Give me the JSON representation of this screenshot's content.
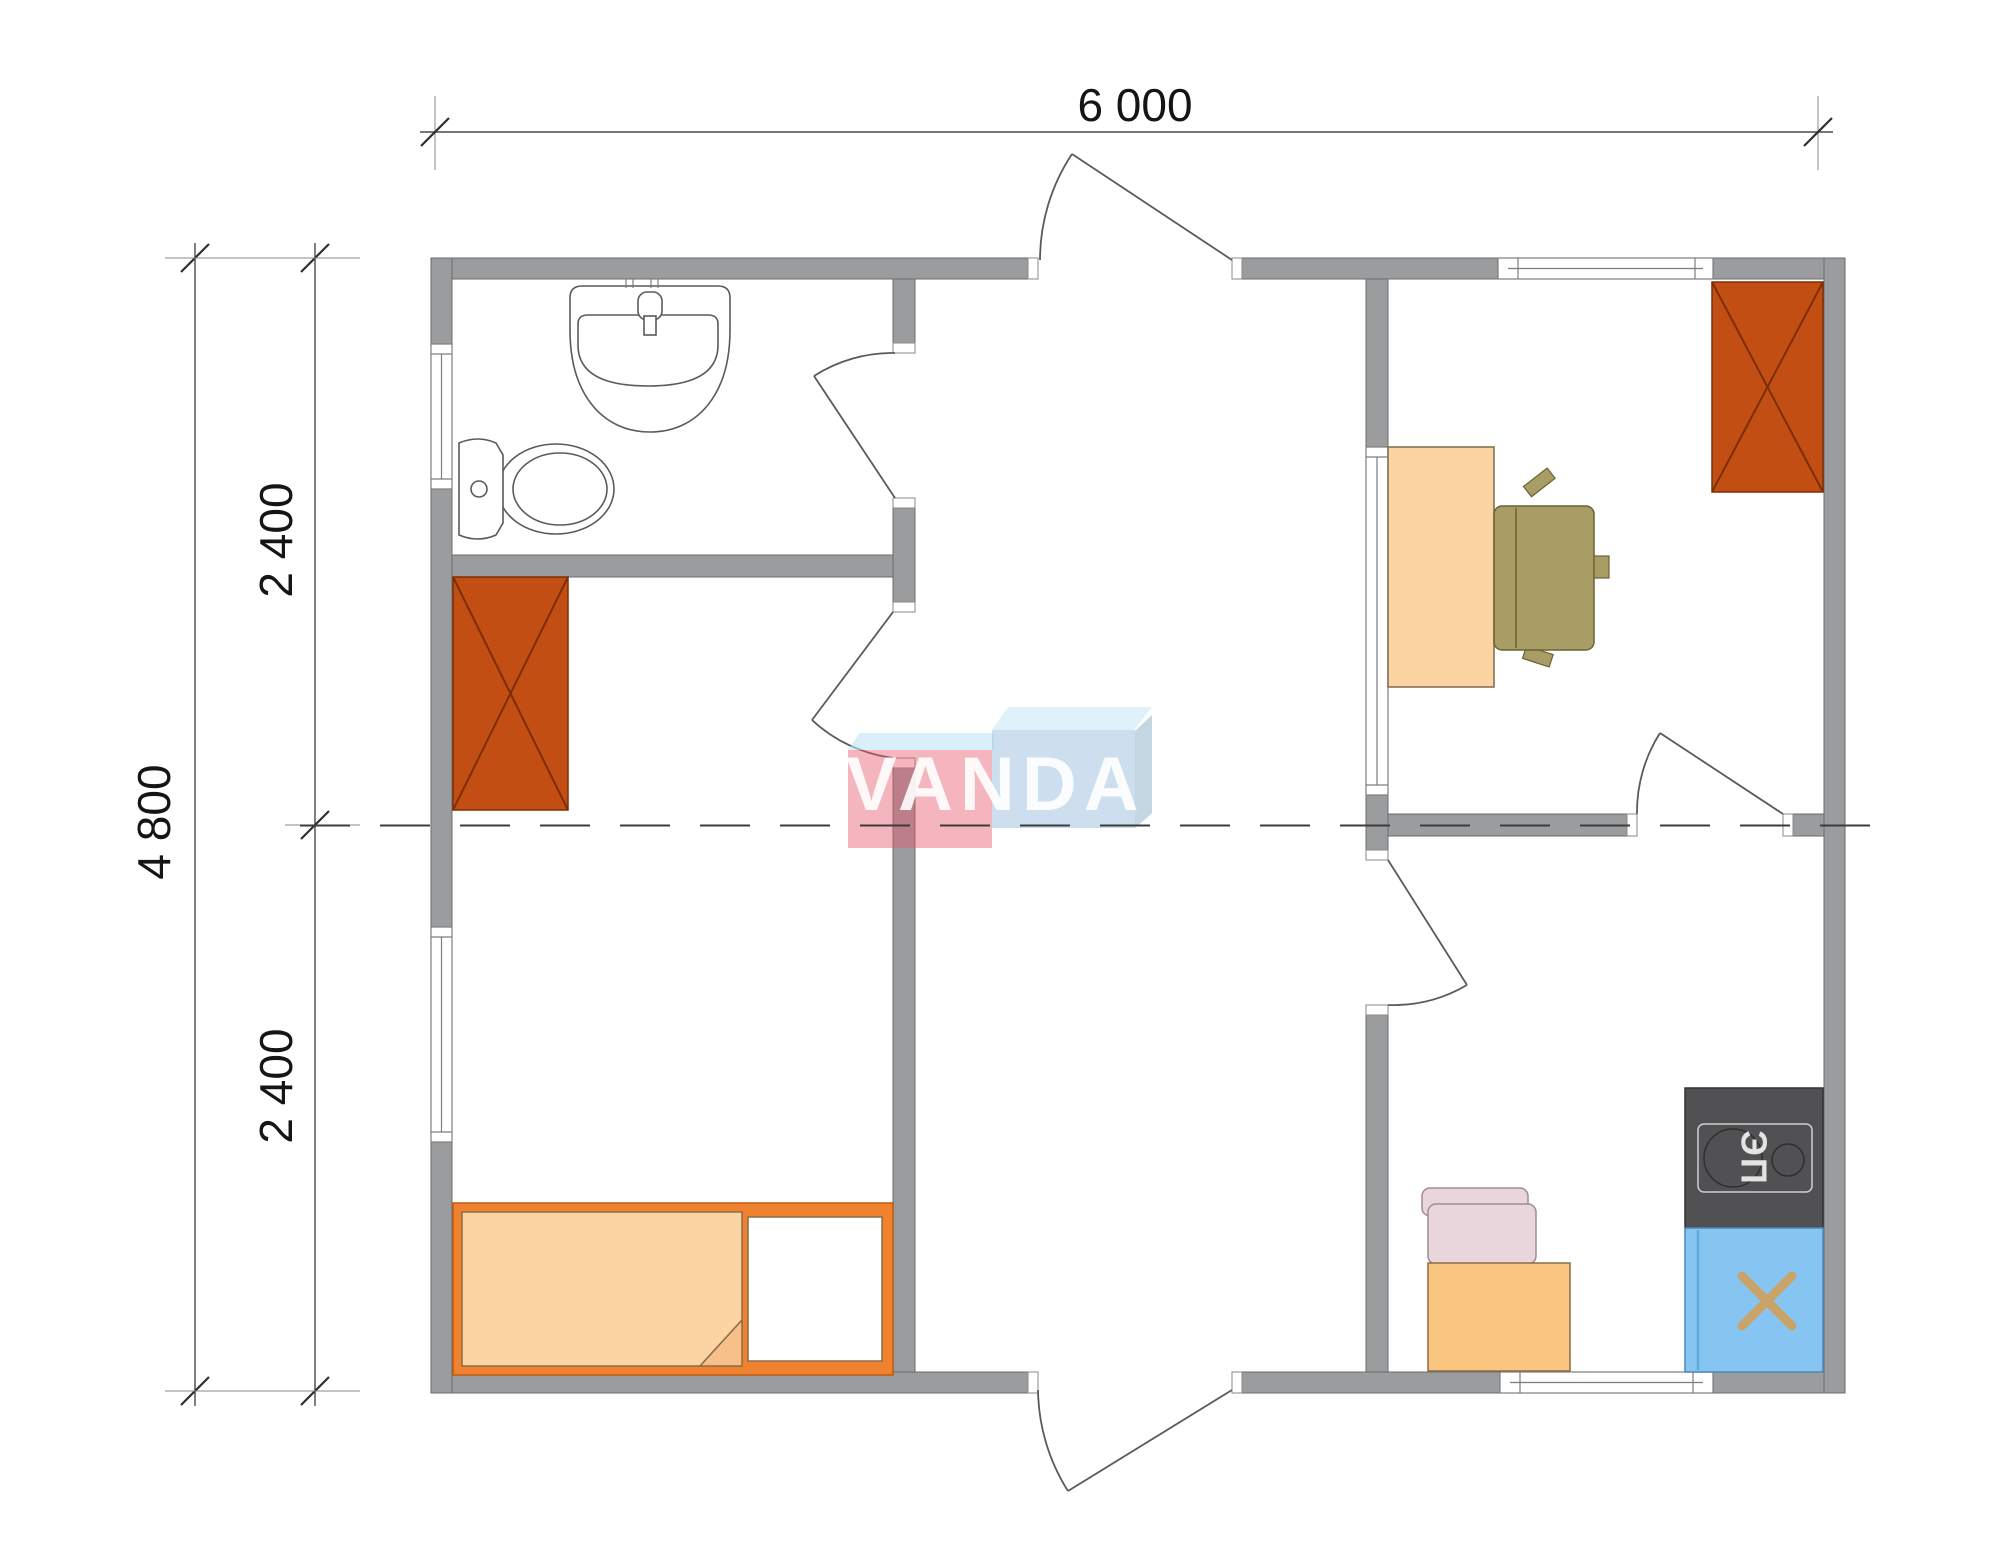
{
  "dimensions": {
    "top": "6 000",
    "left_total": "4 800",
    "left_upper": "2 400",
    "left_lower": "2 400"
  },
  "logo": {
    "text": "VANDA"
  },
  "kitchen": {
    "stove_label": "ЭП"
  },
  "icons": [
    "sink-icon",
    "toilet-icon",
    "wardrobe-x-icon",
    "bed-icon",
    "desk-icon",
    "office-chair-icon",
    "kitchen-chair-icon",
    "kitchen-table-icon",
    "stove-icon",
    "kitchen-sink-icon",
    "door-swing-icon",
    "window-icon"
  ],
  "colors": {
    "wall-fill": "#9a9c9e",
    "wall-stroke": "#6a6c6e",
    "dim-text": "#151515",
    "wardrobe": "#c24e14",
    "wardrobe-line": "#7d2e06",
    "bed-frame": "#f0812f",
    "mattress": "#fcd4a4",
    "mattress-line": "#8a6d46",
    "desk": "#fcd4a4",
    "table": "#f9c57f",
    "chair-olive": "#a89d64",
    "chair-olive-line": "#6b6233",
    "chair-pink": "#e9d6dd",
    "chair-pink-line": "#a08a92",
    "stove": "#515153",
    "stove-line": "#d0d0d0",
    "stove-text": "#e3e3e3",
    "sink-blue": "#86c5f2",
    "sink-blue-line": "#4d87b5",
    "sink-x": "#c9a368",
    "logo-red": "#e75a6e73",
    "logo-red-bevel": "#bfe4f799",
    "logo-blue": "#9cc0dd80",
    "logo-blue-bevel": "#c9e9fa99",
    "logo-blue-side": "#7fa3c273",
    "logo-text": "#ffffffe6"
  }
}
